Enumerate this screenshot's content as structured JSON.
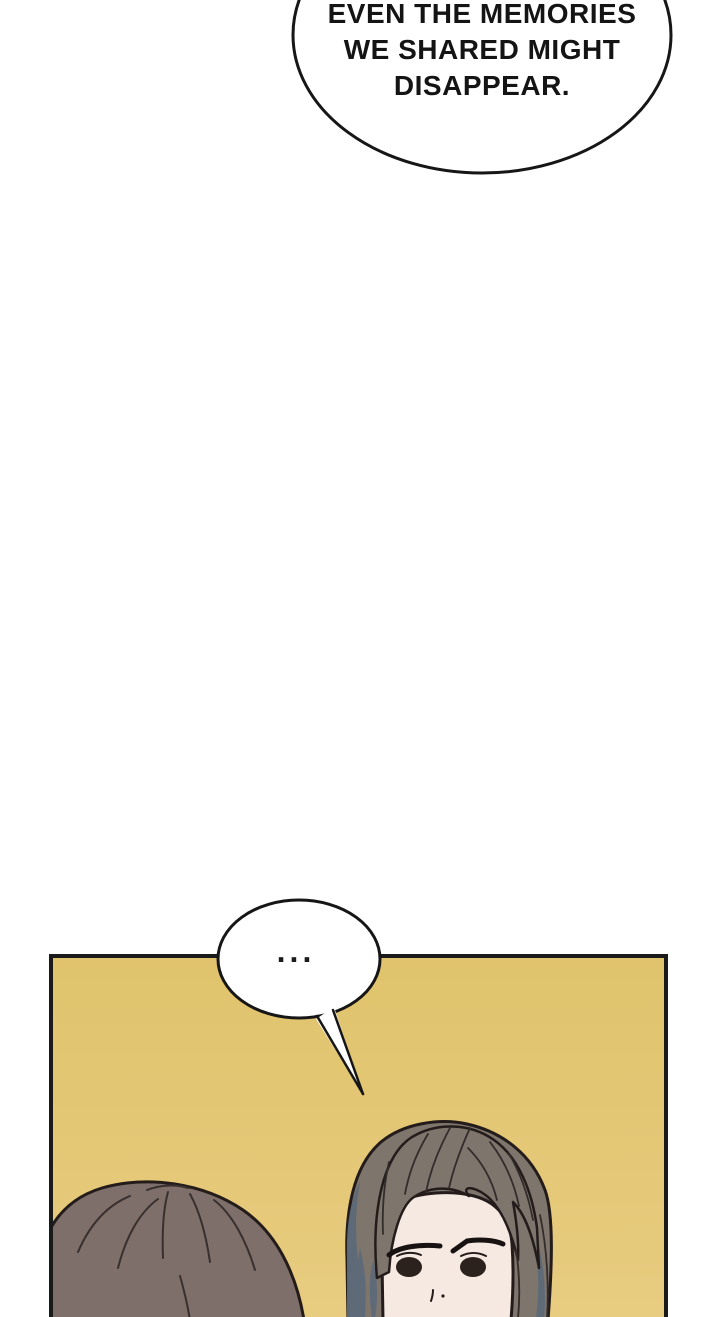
{
  "page": {
    "background": "#ffffff",
    "kind_label": "comic-page"
  },
  "bubbles": {
    "top": {
      "lines": [
        "EVEN THE MEMORIES",
        "WE SHARED MIGHT",
        "DISAPPEAR."
      ],
      "full_text": "EVEN THE MEMORIES WE SHARED MIGHT DISAPPEAR.",
      "fill": "#ffffff",
      "stroke": "#161616"
    },
    "small": {
      "text": "...",
      "fill": "#ffffff",
      "stroke": "#161616"
    }
  },
  "panel": {
    "background_top": "#e0c36c",
    "background_bottom": "#e8cc80",
    "border_color": "#1a1a1a"
  },
  "colors": {
    "text_color": "#141414",
    "outline": "#241c1b",
    "left_character_hair": "#7e6f6a",
    "left_character_hair_line": "#39302e",
    "man_hair": "#7e756d",
    "man_hair_tint": "#5d6a78",
    "man_hair_line": "#342c2a",
    "man_skin": "#f5e9e1",
    "eye_color": "#2b211d",
    "brow_color": "#181212"
  }
}
